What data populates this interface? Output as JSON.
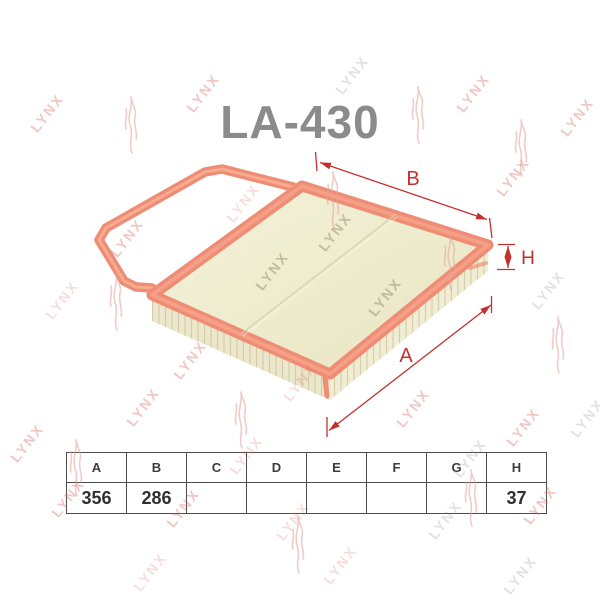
{
  "title": "LA-430",
  "watermark": {
    "text": "LYNX"
  },
  "drawing": {
    "labels": {
      "a": "A",
      "b": "B",
      "h": "H"
    }
  },
  "colors": {
    "dimension_red": "#c4302e",
    "seal_orange": "#ee8d74",
    "seal_highlight": "#f9b89e",
    "media_cream": "#f0eccf",
    "title_gray": "#8b8b8b",
    "watermark_pink": "#d66b64",
    "table_border": "#4d4d4d"
  },
  "table": {
    "headers": [
      "A",
      "B",
      "C",
      "D",
      "E",
      "F",
      "G",
      "H"
    ],
    "values": [
      "356",
      "286",
      "",
      "",
      "",
      "",
      "",
      "37"
    ]
  }
}
